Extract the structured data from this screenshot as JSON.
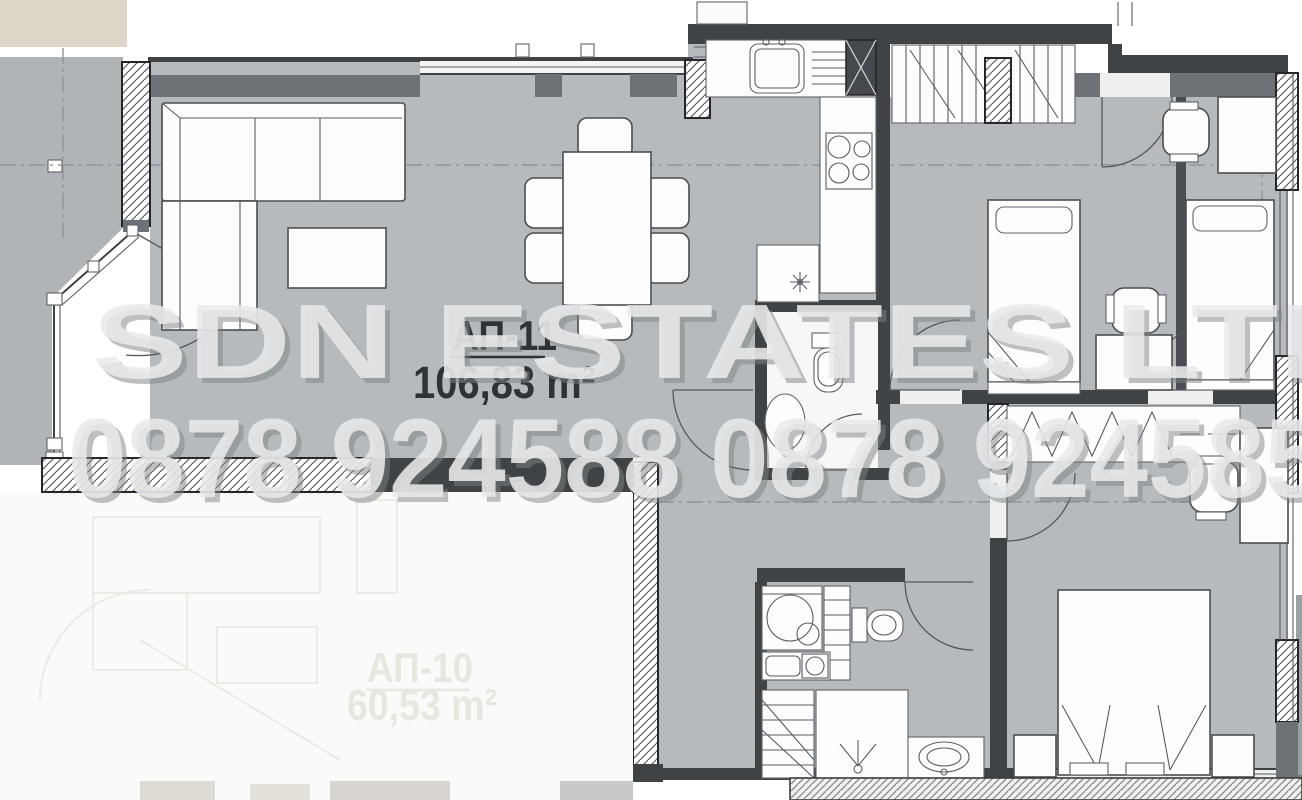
{
  "plan": {
    "apartment": {
      "label": "АП-11",
      "area": "106,83 m²"
    },
    "apartment_faded": {
      "label": "АП-10",
      "area": "60,53 m²"
    },
    "watermark": {
      "company": "SDN ESTATES LTD",
      "phones": "0878 924588 0878 924585"
    },
    "colors": {
      "floor_gray": "#b6babd",
      "wall_dark": "#3f4346",
      "wall_band": "#6d7276",
      "outside_terrace_gray": "#b0b4b7",
      "outside_beige": "#ded7c9",
      "watermark_text": "#e8eaec",
      "label_text": "#303336",
      "faded_label_text": "#e9e6e0"
    }
  }
}
